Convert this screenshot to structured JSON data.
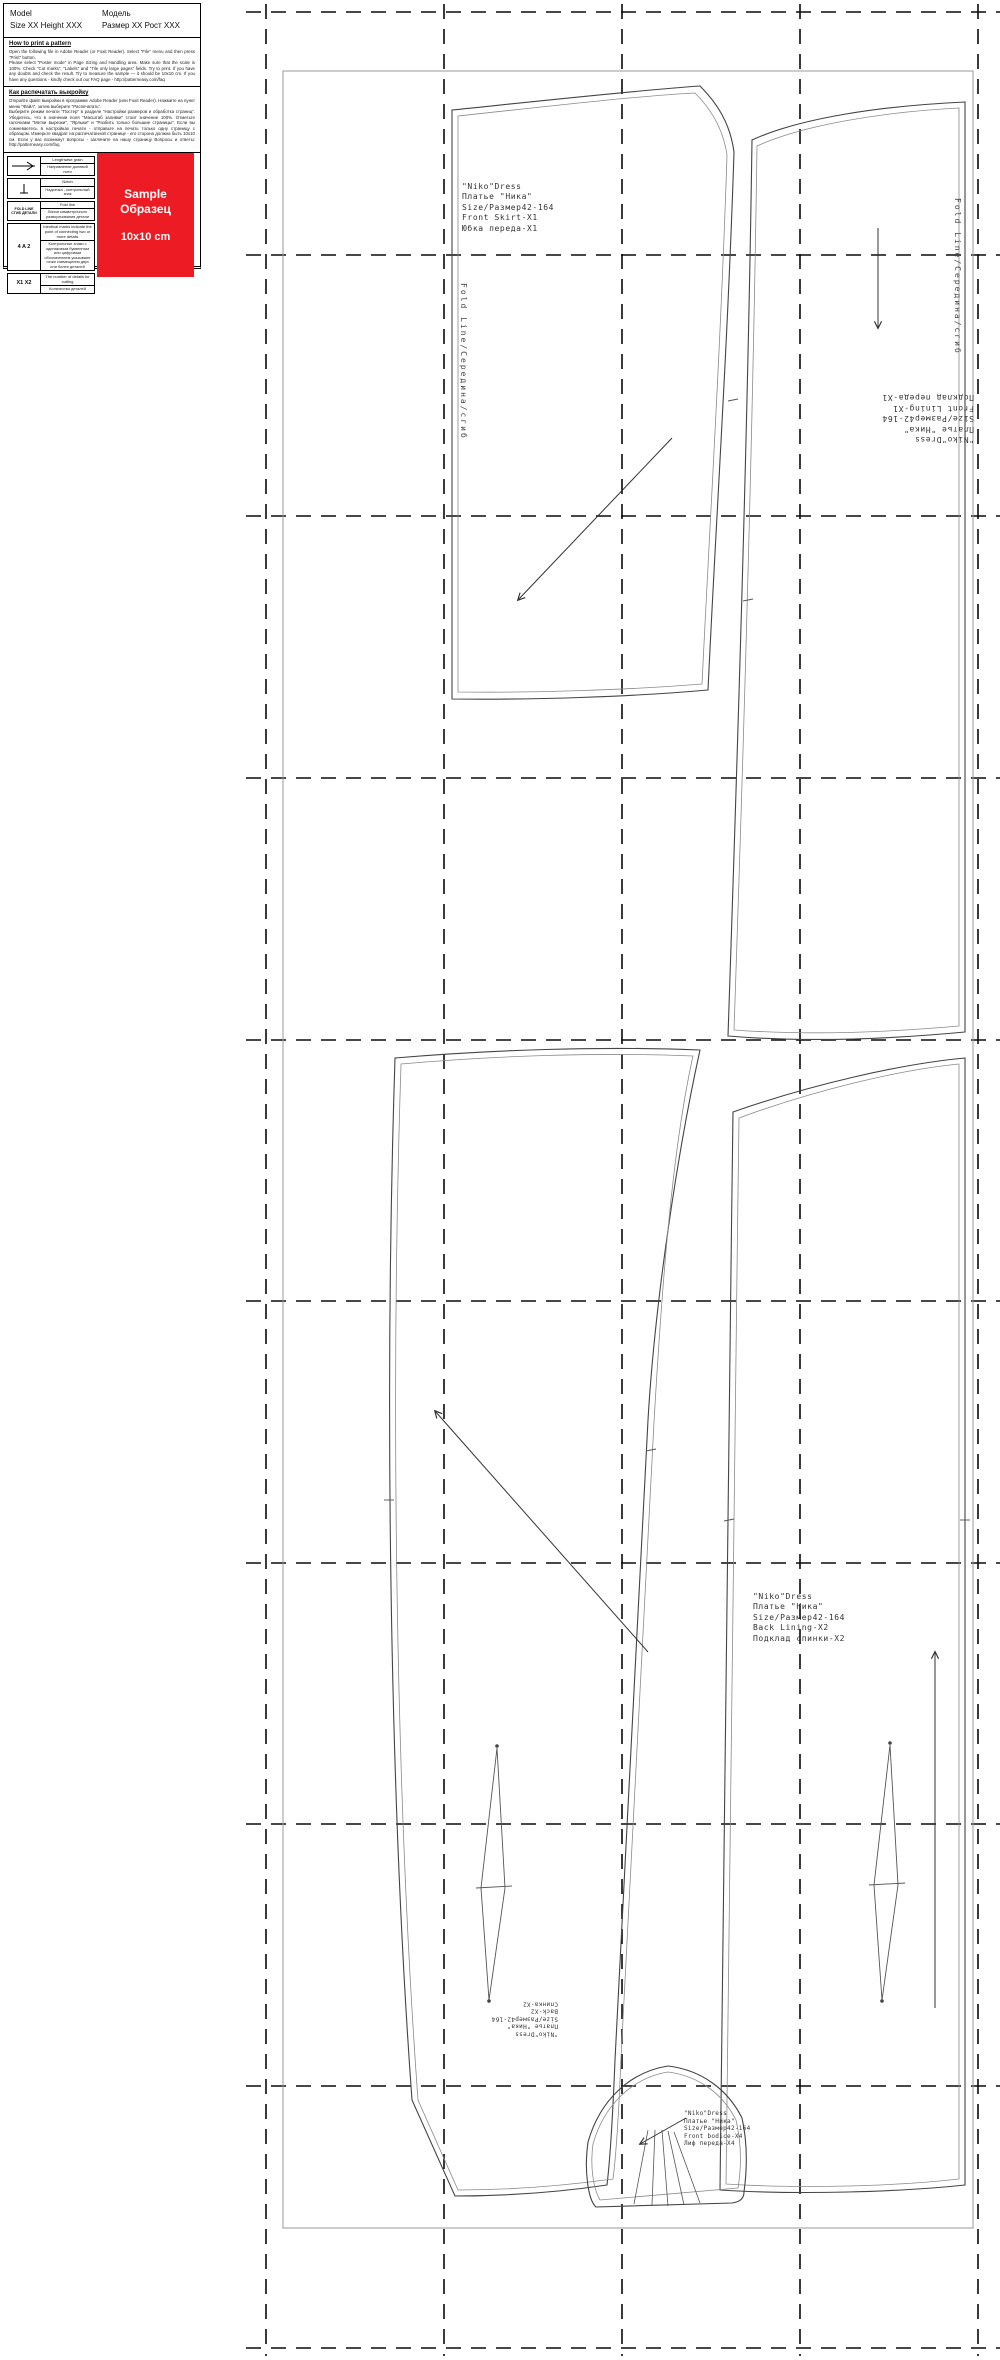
{
  "info_box": {
    "model_left": "Model\nSize XX Height XXX",
    "model_right": "Модель\nРазмер XX Рост XXX",
    "print_en_title": "How to print a pattern",
    "print_en_body": "Open the following file in Adobe Reader (or Foxit Reader). Select \"File\" menu and then press \"Print\" button.\nPlease select \"Poster mode\" in Page Sizing and Handling area. Make sure that the scale is 100%. Check \"Cut marks\", \"Labels\" and \"Tile only large pages\" fields. Try to print. If you have any doubts and check the result. Try to measure the sample — it should be 10x10 cm. If you have any questions - kindly check out our FAQ page - http://patterneasy.com/faq",
    "print_ru_title": "Как распечатать выкройку",
    "print_ru_body": "Откройте файл выкройки в программе Adobe Reader (или Foxit Reader). Нажмите на пункт меню \"Файл\", затем выберите \"Распечатать\".\nВыберите режим печати \"Постер\" в разделе \"Настройки размеров и обработка страниц\". Убедитесь, что в значении поля \"Масштаб заливки\" стоит значение 100%. Отметьте галочками \"Метки вырезки\", \"Ярлыки\" и \"Разбить только большие страницы\". Если вы сомневаетесь в настройках печати - отправьте на печать только одну страницу с образцом. Измерьте квадрат на распечатанной странице - его сторона должна быть 10х10 см. Если у вас возникнут вопросы - загляните на нашу страницу Вопросы и ответы: http://patterneasy.com/faq",
    "legend": [
      {
        "symbol": "",
        "en": "Lengthwise grain",
        "ru": "Направление долевой нити"
      },
      {
        "symbol": "",
        "en": "Notch",
        "ru": "Надсечка - контрольный знак"
      },
      {
        "symbol": "FOLD LINE\nСГИБ ДЕТАЛИ",
        "en": "Fold line",
        "ru": "Линия симметричного разворачивания детали"
      },
      {
        "symbol": "4 A 2",
        "en": "Identical marks indicate the point of connecting two or more details",
        "ru": "Контрольные знаки с одинаковым буквенным или цифровым обозначением указывают точки совмещения двух или более деталей"
      },
      {
        "symbol": "X1 X2",
        "en": "The number of details for cutting",
        "ru": "Количество деталей"
      }
    ],
    "sample": {
      "line1": "Sample\nОбразец",
      "size_label": "10x10 cm",
      "color": "#ed1c24"
    }
  },
  "pieces": {
    "front_skirt_label": "\"Niko\"Dress\nПлатье \"Ника\"\nSize/Размер42-164\nFront Skirt-X1\nЮбка переда-X1",
    "front_lining_label": "\"Niko\"Dress\nПлатье \"Ника\"\nSize/Размер42-164\nFront Lining-X1\nПодклад переда-X1",
    "back_label": "\"Niko\"Dress\nПлатье \"Ника\"\nSize/Размер42-164\nBack-X2\nСпинка-X2",
    "back_lining_label": "\"Niko\"Dress\nПлатье \"Ника\"\nSize/Размер42-164\nBack Lining-X2\nПодклад спинки-X2",
    "front_bodice_label": "\"Niko\"Dress\nПлатье \"Ника\"\nSize/Размер42-164\nFront bodice-X4\nЛиф переда-X4",
    "fold_line_left": "Fold Line/Середина/сгиб",
    "fold_line_right": "Fold Line/Середина/сгиб"
  }
}
